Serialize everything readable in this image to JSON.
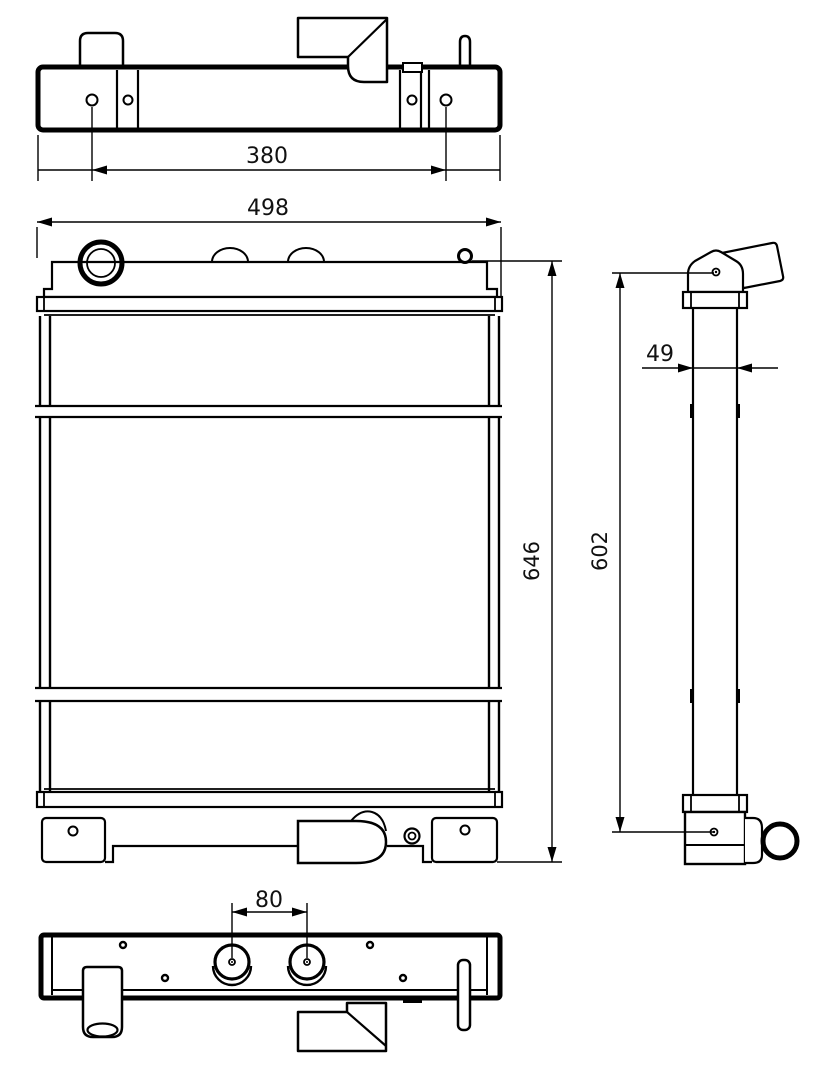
{
  "drawing": {
    "background": "#ffffff",
    "line_color": "#000000",
    "views": {
      "top": {
        "name": "top view"
      },
      "front": {
        "name": "front view"
      },
      "side": {
        "name": "side view"
      },
      "bottom": {
        "name": "bottom view"
      }
    },
    "dimensions": {
      "top_hole_spacing": {
        "label": "380",
        "value": 380,
        "view": "top",
        "orientation": "horizontal"
      },
      "overall_width": {
        "label": "498",
        "value": 498,
        "view": "front",
        "orientation": "horizontal"
      },
      "overall_height": {
        "label": "646",
        "value": 646,
        "view": "front",
        "orientation": "vertical"
      },
      "core_depth": {
        "label": "49",
        "value": 49,
        "view": "side",
        "orientation": "horizontal"
      },
      "side_height": {
        "label": "602",
        "value": 602,
        "view": "side",
        "orientation": "vertical"
      },
      "boss_spacing": {
        "label": "80",
        "value": 80,
        "view": "bottom",
        "orientation": "horizontal"
      }
    }
  }
}
